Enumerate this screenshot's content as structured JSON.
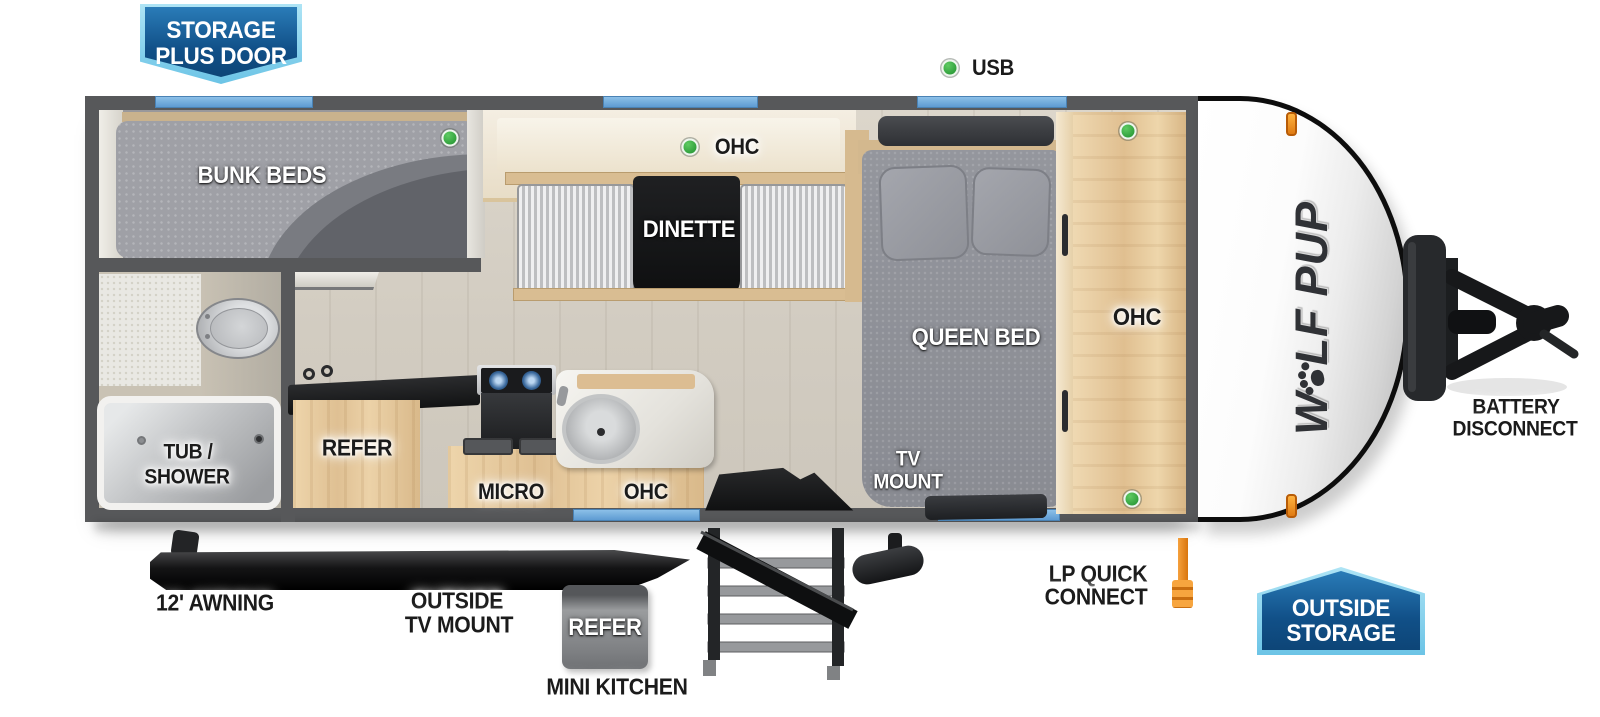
{
  "title": "Wolf Pup travel trailer floor plan",
  "badges": {
    "storage_plus_door": [
      "STORAGE",
      "PLUS DOOR"
    ],
    "outside_storage": [
      "OUTSIDE",
      "STORAGE"
    ]
  },
  "callouts": {
    "usb": "USB",
    "awning": "12' AWNING",
    "outside_tv_mount": [
      "OUTSIDE",
      "TV MOUNT"
    ],
    "mini_kitchen_refer": "REFER",
    "mini_kitchen": "MINI KITCHEN",
    "lp_quick_connect": [
      "LP QUICK",
      "CONNECT"
    ],
    "battery_disconnect": [
      "BATTERY",
      "DISCONNECT"
    ]
  },
  "rooms": {
    "bunk_beds": "BUNK BEDS",
    "dinette_ohc": "OHC",
    "dinette": "DINETTE",
    "shelf": "SHELF",
    "queen_bed": "QUEEN BED",
    "bedroom_ohc": "OHC",
    "tub_shower": [
      "TUB /",
      "SHOWER"
    ],
    "refer": "REFER",
    "micro": "MICRO",
    "kitchen_ohc": "OHC",
    "tv_mount": [
      "TV",
      "MOUNT"
    ]
  },
  "brand": {
    "logo": [
      "W",
      "LF",
      "PUP"
    ]
  },
  "colors": {
    "wall": "#57585a",
    "window_blue": "#6fa9dd",
    "badge_blue_dark": "#0d4577",
    "badge_blue_light": "#6cc4e6",
    "indicator_green": "#3cb34a",
    "accent_orange": "#f08b1e",
    "wood": "#e3c9a2",
    "floor": "#d6d0c5",
    "fabric_gray": "#8e9096"
  }
}
